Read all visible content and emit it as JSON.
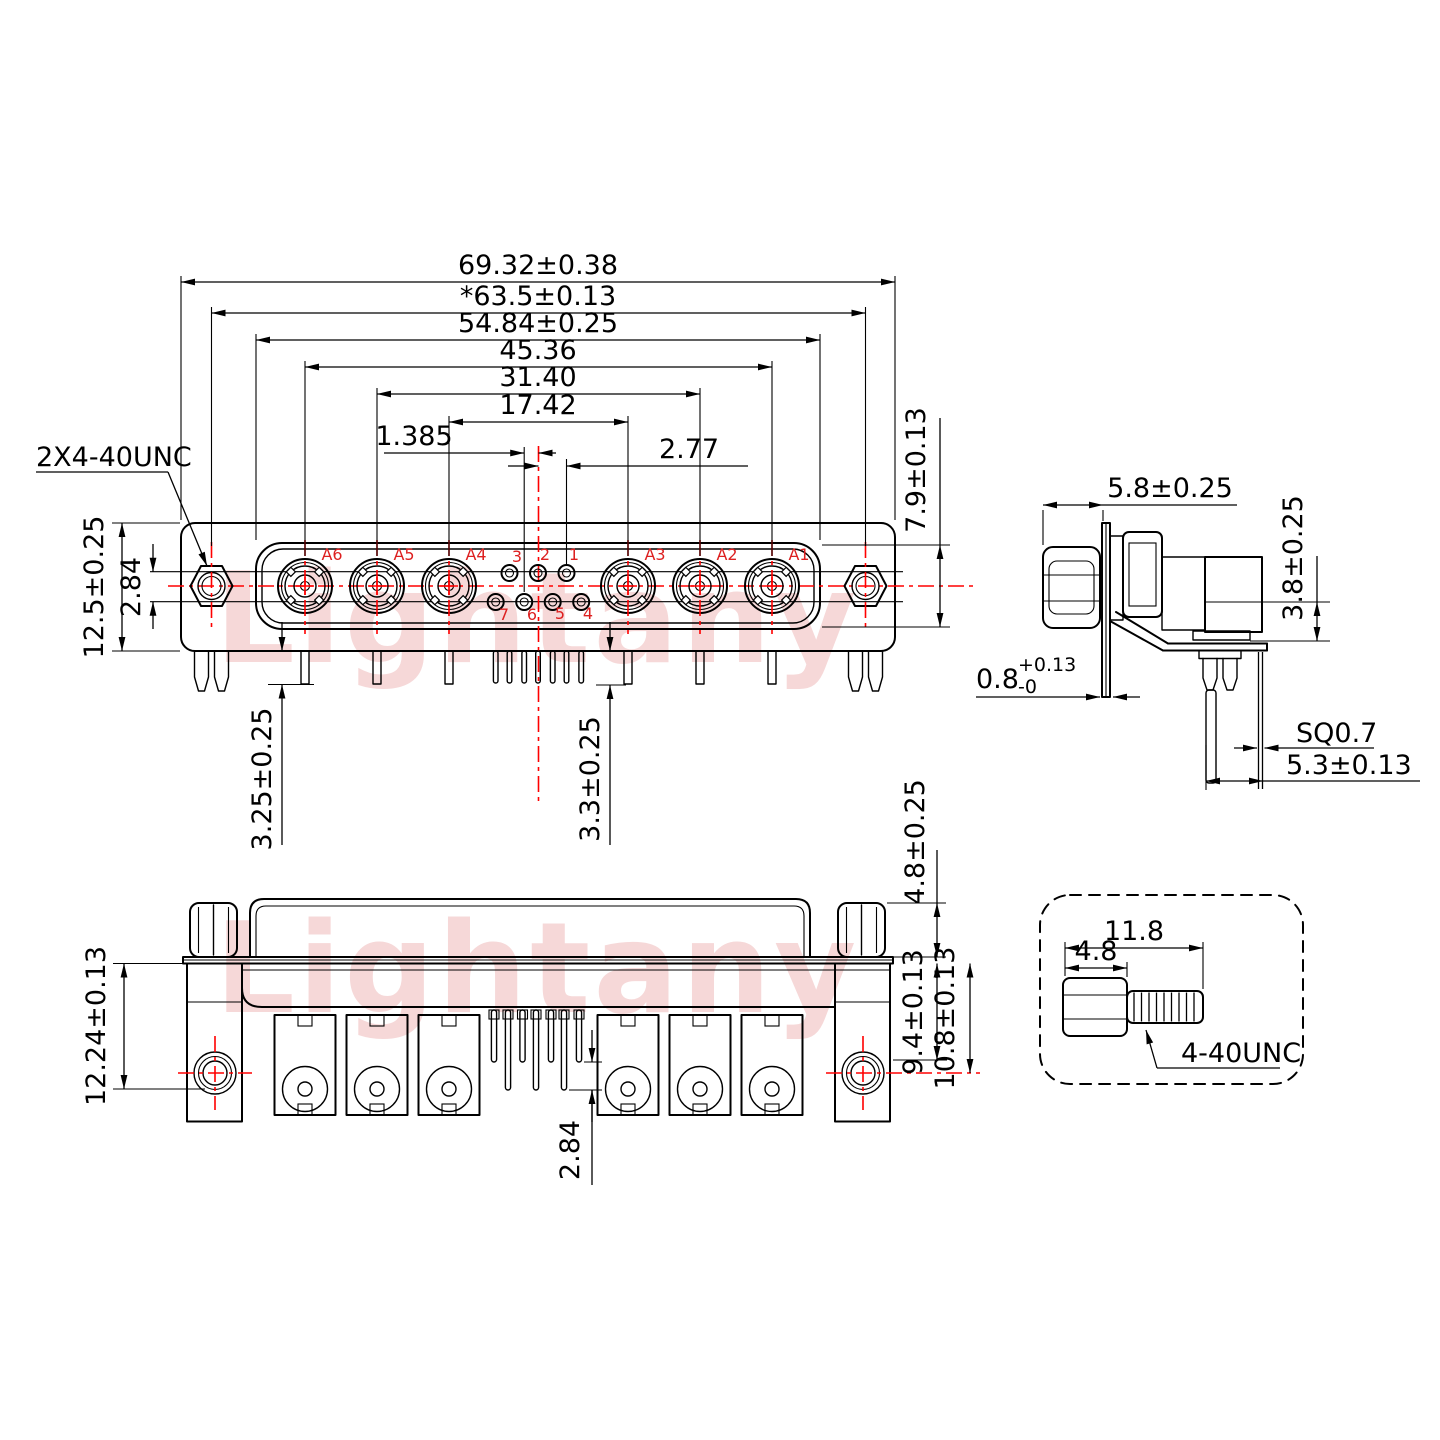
{
  "watermark": {
    "text": "Lightany"
  },
  "colors": {
    "line": "#000000",
    "centerline": "#ff0000",
    "pin_label": "#dd2020",
    "watermark": "rgba(219,100,100,0.25)"
  },
  "front_view": {
    "thread_callout": "2X4-40UNC",
    "dim_overall_width": "69.32±0.38",
    "dim_mounting_span": "*63.5±0.13",
    "dim_shell_width": "54.84±0.25",
    "dim_span_a6_a1": "45.36",
    "dim_span_a5_a2": "31.40",
    "dim_span_a4_a3": "17.42",
    "dim_pin_offset": "1.385",
    "dim_pin_pitch": "2.77",
    "dim_shell_height": "7.9±0.13",
    "dim_body_height": "12.5±0.25",
    "dim_row_gap": "2.84",
    "dim_coax_tail": "3.25±0.25",
    "dim_pin_tail": "3.3±0.25",
    "coax_labels": [
      "A6",
      "A5",
      "A4",
      "A3",
      "A2",
      "A1"
    ],
    "pin_labels_top": [
      "3",
      "2",
      "1"
    ],
    "pin_labels_bottom": [
      "7",
      "6",
      "5",
      "4"
    ]
  },
  "side_view": {
    "dim_standoff_length": "5.8±0.25",
    "dim_bracket_height": "3.8±0.25",
    "dim_flange_thickness": "0.8",
    "dim_flange_tol_upper": "+0.13",
    "dim_flange_tol_lower": "-0",
    "dim_pin_square": "SQ0.7",
    "dim_pin_setback": "5.3±0.13"
  },
  "bottom_view": {
    "dim_bracket_depth": "12.24±0.13",
    "dim_screw_head": "4.8±0.25",
    "dim_short_pin_reach": "9.4±0.13",
    "dim_hole_center": "10.8±0.13",
    "dim_row_gap": "2.84"
  },
  "screw_detail": {
    "dim_overall_length": "11.8",
    "dim_head_length": "4.8",
    "thread_callout": "4-40UNC"
  }
}
